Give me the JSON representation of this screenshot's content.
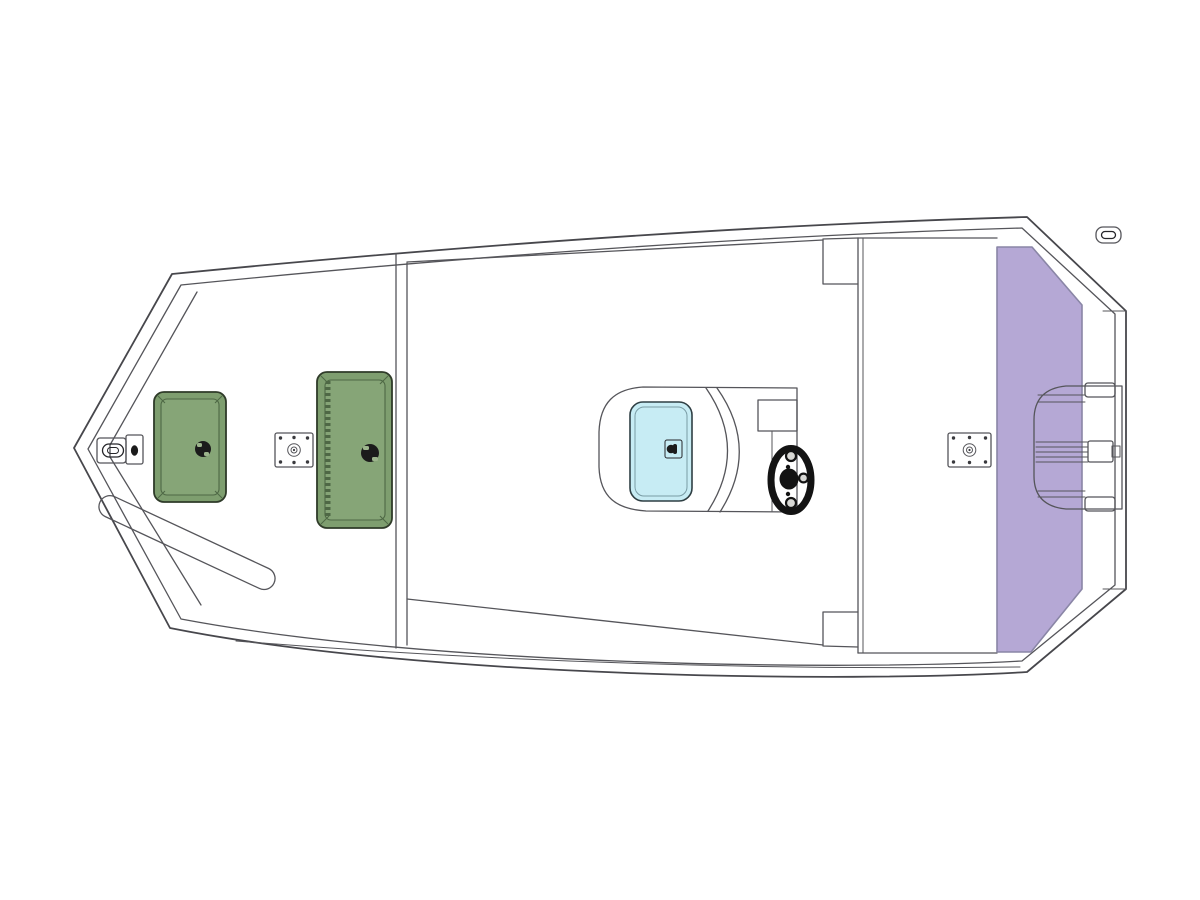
{
  "diagram": {
    "kind": "boat-deck-floorplan",
    "view": "top-down",
    "orientation": "bow-left-stern-right"
  },
  "colors": {
    "background": "#ffffff",
    "hull_fill": "#d8d8d5",
    "console_fill": "#dbdbd8",
    "line": "#55555a",
    "hatch_fill": "#7e9e6f",
    "hatch_inner_fill": "#86a577",
    "hatch_border": "#2f3b29",
    "hatch_detail": "#4e6845",
    "hatch_notch": "#9cb48c",
    "latch_black": "#1b1b1b",
    "platform_fill": "#b5a8d5",
    "platform_border": "#8a86a6",
    "windshield_fill": "#c7ecf4",
    "windshield_border": "#2f3f44",
    "wheel_black": "#131313",
    "metal_slot": "#9a9a96"
  },
  "parts": [
    "hull-outline",
    "rub-rail-line",
    "bow-liner-line",
    "hull-strake-line",
    "floor-edge-lines",
    "gunwale-box-top",
    "gunwale-box-bottom",
    "aft-deck",
    "rear-platform",
    "motor-well",
    "motor-mount",
    "bow-cleat",
    "stern-cleat",
    "bow-bench",
    "bow-storage-hatch",
    "midship-storage-hatch",
    "hatch-latch",
    "seat-base-forward",
    "seat-base-aft",
    "center-console",
    "console-windshield",
    "windshield-latch-icon",
    "console-dash",
    "steering-wheel"
  ]
}
